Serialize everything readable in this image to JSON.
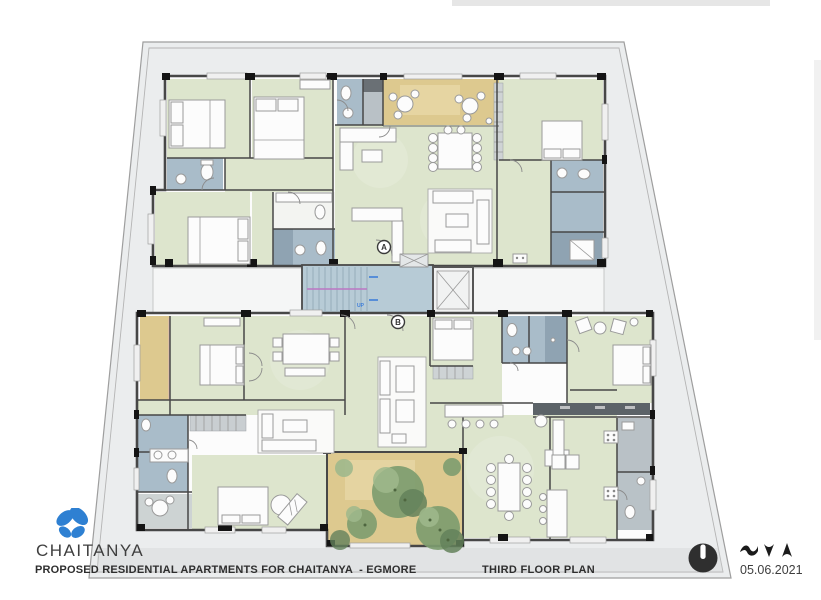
{
  "branding": {
    "name": "CHAITANYA",
    "logo_icon": "butterfly-icon",
    "logo_color": "#2e80d2"
  },
  "titleblock": {
    "project_title": "PROPOSED RESIDENTIAL APARTMENTS FOR CHAITANYA  - EGMORE",
    "drawing_title": "THIRD FLOOR PLAN",
    "date": "05.06.2021",
    "north_icon": "north-indicator-icon",
    "marks_icon": "bird-marks-icon"
  },
  "plan": {
    "section_markers": [
      {
        "label": "A"
      },
      {
        "label": "B"
      }
    ],
    "stair_label": "UP"
  },
  "colors": {
    "site_fill": "#ebedee",
    "site_stroke": "#9e9e9e",
    "wall": "#474747",
    "tick": "#141414",
    "room_green": "#dde5cd",
    "room_green_dark": "#cfdabc",
    "bath_blue": "#a9bcc9",
    "bath_blue_dark": "#8fa3b2",
    "balcony_tan": "#ddc98f",
    "balcony_tan_light": "#e8d8a8",
    "stair_blue": "#b7cbd6",
    "utility_gray": "#b9c1c6",
    "dark_band": "#5c6368",
    "furniture_stroke": "#9a9a9a",
    "furniture_fill": "#fcfcfc",
    "tree_green": "#7d9c6f",
    "tree_green_dark": "#63815b",
    "tree_green_light": "#9fb88c",
    "logo_blue": "#2e80d2",
    "text_dark": "#3c3c3c",
    "north_fill": "#2f2f2f",
    "rail_magenta": "#bb76c4",
    "arrow_blue": "#3f7fd9"
  }
}
